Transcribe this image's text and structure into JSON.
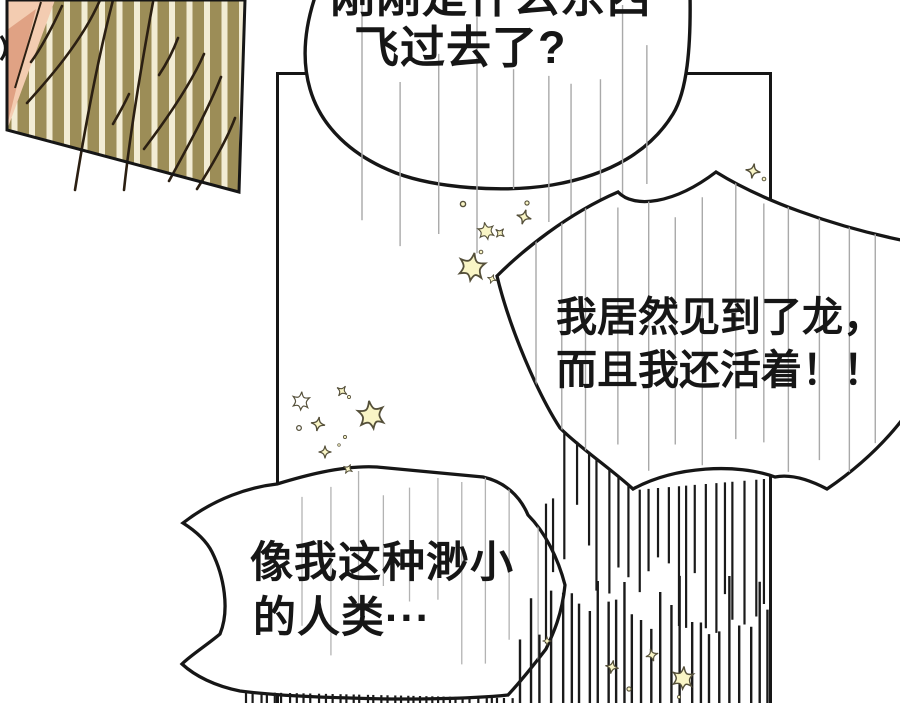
{
  "page": {
    "kind": "comic-page"
  },
  "bubbles": {
    "top": {
      "line1": "刚刚是什么东西",
      "line2": "飞过去了?"
    },
    "mid": {
      "line1": "我居然见到了龙，",
      "line2": "而且我还活着！！"
    },
    "bottom": {
      "line1": "像我这种渺小",
      "line2": "的人类···"
    }
  },
  "colors": {
    "paper": "#ffffff",
    "ink": "#161616",
    "speedline_gray": "#a9a9a9",
    "speedline_gray_soft": "#b3b3b3",
    "burst_black": "#1a1a1a",
    "stripe_olive": "#9c8d57",
    "stripe_cream": "#f2ecd4",
    "skin_light": "#f3ccb1",
    "skin_shadow": "#e0a284",
    "hair_line": "#2b1f12",
    "star_fill": "#f9f5c6",
    "star_edge": "#55503a"
  }
}
